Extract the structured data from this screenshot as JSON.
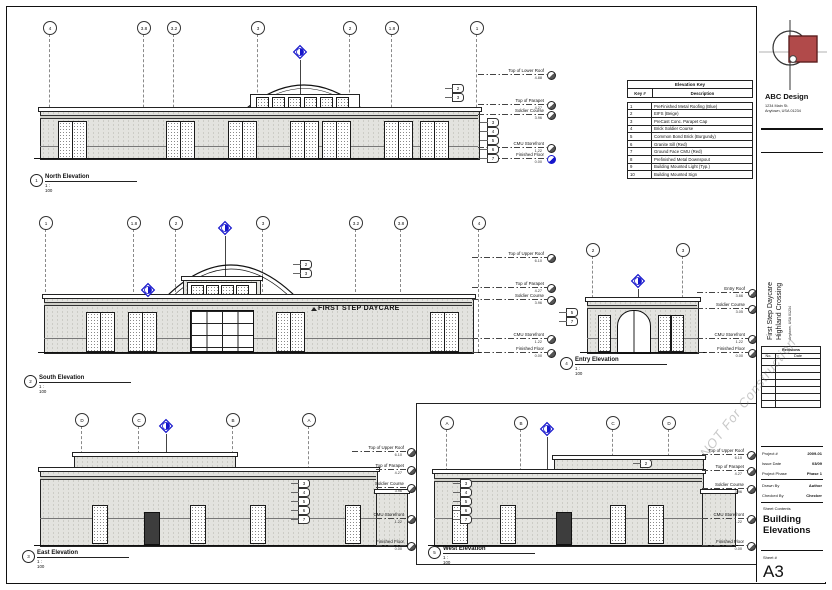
{
  "sheet": {
    "firm": {
      "name": "ABC Design",
      "address1": "1234 Main St.",
      "address2": "Anytown, USA 01234"
    },
    "project": {
      "line1": "First Step Daycare",
      "line2": "Highland Crossing",
      "address": "Anytown, USA 01234"
    },
    "revisions": {
      "title": "Revisions",
      "no": "No.",
      "date": "Date"
    },
    "fields": [
      {
        "label": "Project #",
        "value": "2009-01"
      },
      {
        "label": "Issue Date",
        "value": "03/09"
      },
      {
        "label": "Project Phase",
        "value": "Phase 1"
      },
      {
        "label": "Drawn By",
        "value": "Author"
      },
      {
        "label": "Checked By",
        "value": "Checker"
      }
    ],
    "contents_label": "Sheet Contents",
    "contents": "Building Elevations",
    "number_label": "Sheet #",
    "number": "A3",
    "watermark": "NOT For Construction"
  },
  "key_table": {
    "title": "Elevation Key",
    "col_key": "Key #",
    "col_desc": "Description",
    "rows": [
      {
        "key": "1",
        "desc": "PreFinished Metal Roofing (Blue)"
      },
      {
        "key": "2",
        "desc": "EIFS (Beige)"
      },
      {
        "key": "3",
        "desc": "PreCast Conc. Parapet Cap"
      },
      {
        "key": "4",
        "desc": "Brick Soldier Course"
      },
      {
        "key": "5",
        "desc": "Common Bond Brick (Burgundy)"
      },
      {
        "key": "6",
        "desc": "Granite Sill (Red)"
      },
      {
        "key": "7",
        "desc": "Ground Face CMU (Red)"
      },
      {
        "key": "8",
        "desc": "Prefinished Metal Downspout"
      },
      {
        "key": "9",
        "desc": "Building Mounted Light (Typ.)"
      },
      {
        "key": "10",
        "desc": "Building Mounted Sign"
      }
    ]
  },
  "views": {
    "north": {
      "marker": "1",
      "title": "North Elevation",
      "scale": "1 : 100",
      "grids": [
        "4",
        "3.8",
        "3.2",
        "3",
        "2",
        "1.8",
        "1"
      ],
      "levels": [
        {
          "name": "Top of Lower Roof",
          "value": "4.88"
        },
        {
          "name": "Top of Parapet",
          "value": "4.27"
        },
        {
          "name": "Soldier Course",
          "value": "3.96"
        },
        {
          "name": "CMU Storefront",
          "value": "1.22"
        },
        {
          "name": "Finished Floor",
          "value": "0.00"
        }
      ],
      "tags": [
        "2",
        "3",
        "3",
        "4",
        "5",
        "6",
        "7"
      ]
    },
    "south": {
      "marker": "2",
      "title": "South Elevation",
      "scale": "1 : 100",
      "signage": "FIRST STEP DAYCARE",
      "grids": [
        "1",
        "1.8",
        "2",
        "3",
        "3.2",
        "3.8",
        "4"
      ],
      "levels": [
        {
          "name": "Top of Upper Roof",
          "value": "6.10"
        },
        {
          "name": "Top of Parapet",
          "value": "4.27"
        },
        {
          "name": "Soldier Course",
          "value": "3.96"
        },
        {
          "name": "CMU Storefront",
          "value": "1.22"
        },
        {
          "name": "Finished Floor",
          "value": "0.00"
        }
      ],
      "tags": [
        "2",
        "3"
      ]
    },
    "entry": {
      "marker": "4",
      "title": "Entry Elevation",
      "scale": "1 : 100",
      "grids": [
        "2",
        "3"
      ],
      "levels": [
        {
          "name": "Entry Roof",
          "value": "3.66"
        },
        {
          "name": "Soldier Course",
          "value": "3.05"
        },
        {
          "name": "CMU Storefront",
          "value": "1.22"
        },
        {
          "name": "Finished Floor",
          "value": "0.00"
        }
      ],
      "tags": [
        "5",
        "7"
      ]
    },
    "east": {
      "marker": "3",
      "title": "East Elevation",
      "scale": "1 : 100",
      "grids": [
        "D",
        "C",
        "B",
        "A"
      ],
      "levels": [
        {
          "name": "Top of Upper Roof",
          "value": "6.10"
        },
        {
          "name": "Top of Parapet",
          "value": "4.27"
        },
        {
          "name": "Soldier Course",
          "value": "3.96"
        },
        {
          "name": "CMU Storefront",
          "value": "1.22"
        },
        {
          "name": "Finished Floor",
          "value": "0.00"
        }
      ],
      "tags": [
        "3",
        "4",
        "5",
        "6",
        "7"
      ]
    },
    "west": {
      "marker": "5",
      "title": "West Elevation",
      "scale": "1 : 100",
      "grids": [
        "A",
        "B",
        "C",
        "D"
      ],
      "levels": [
        {
          "name": "Top of Upper Roof",
          "value": "6.10"
        },
        {
          "name": "Top of Parapet",
          "value": "4.27"
        },
        {
          "name": "Soldier Course",
          "value": "3.96"
        },
        {
          "name": "CMU Storefront",
          "value": "1.22"
        },
        {
          "name": "Finished Floor",
          "value": "0.00"
        }
      ],
      "tags": [
        "2",
        "3",
        "4",
        "5",
        "6",
        "7"
      ]
    }
  }
}
